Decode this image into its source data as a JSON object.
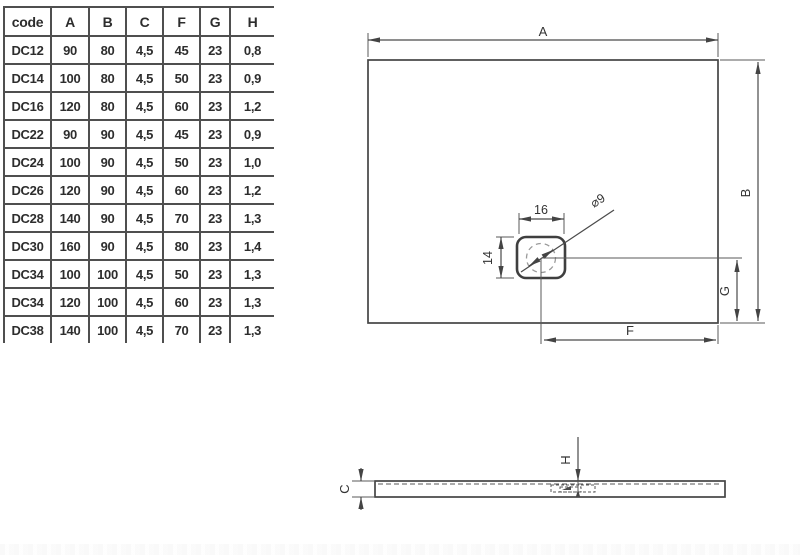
{
  "table": {
    "headers": [
      "code",
      "A",
      "B",
      "C",
      "F",
      "G",
      "H"
    ],
    "rows": [
      [
        "DC12",
        "90",
        "80",
        "4,5",
        "45",
        "23",
        "0,8"
      ],
      [
        "DC14",
        "100",
        "80",
        "4,5",
        "50",
        "23",
        "0,9"
      ],
      [
        "DC16",
        "120",
        "80",
        "4,5",
        "60",
        "23",
        "1,2"
      ],
      [
        "DC22",
        "90",
        "90",
        "4,5",
        "45",
        "23",
        "0,9"
      ],
      [
        "DC24",
        "100",
        "90",
        "4,5",
        "50",
        "23",
        "1,0"
      ],
      [
        "DC26",
        "120",
        "90",
        "4,5",
        "60",
        "23",
        "1,2"
      ],
      [
        "DC28",
        "140",
        "90",
        "4,5",
        "70",
        "23",
        "1,3"
      ],
      [
        "DC30",
        "160",
        "90",
        "4,5",
        "80",
        "23",
        "1,4"
      ],
      [
        "DC34",
        "100",
        "100",
        "4,5",
        "50",
        "23",
        "1,3"
      ],
      [
        "DC34",
        "120",
        "100",
        "4,5",
        "60",
        "23",
        "1,3"
      ],
      [
        "DC38",
        "140",
        "100",
        "4,5",
        "70",
        "23",
        "1,3"
      ]
    ]
  },
  "plan_view": {
    "labels": {
      "width": "A",
      "height": "B",
      "drain_width": "16",
      "drain_height": "14",
      "drain_diameter": "⌀9",
      "drain_offset_x": "F",
      "drain_offset_y": "G"
    }
  },
  "section_view": {
    "labels": {
      "thickness": "C",
      "rim_height": "H"
    }
  },
  "colors": {
    "line": "#4a4a4a",
    "text": "#2d2d2d",
    "dashed": "#9a9a9a",
    "background": "#ffffff"
  }
}
